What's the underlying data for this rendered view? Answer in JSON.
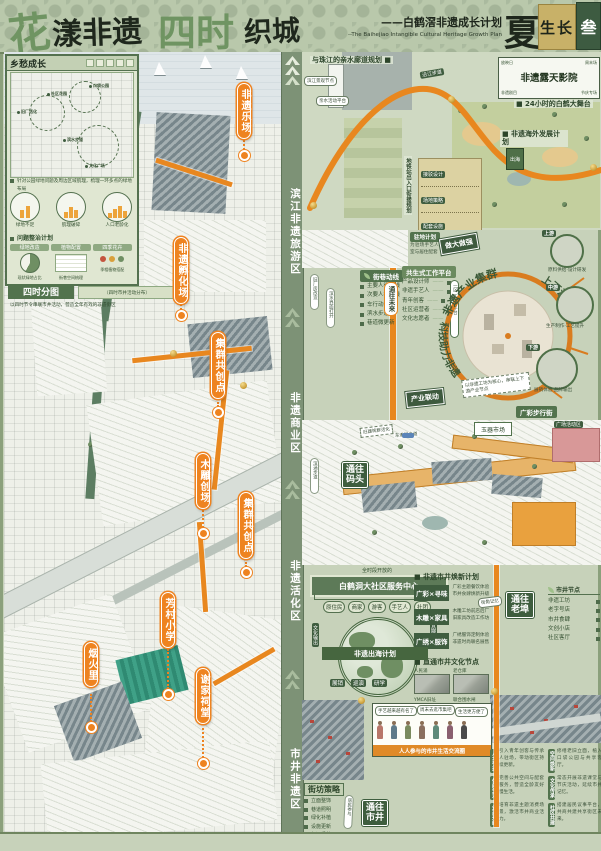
{
  "header": {
    "t1": "花",
    "t2": "漾非遗",
    "t3": "四时",
    "t4": "织城",
    "subtitle_cn": "——白鹤滘非遗成长计划",
    "subtitle_en": "--The Baihejiao Intangible Cultural Heritage Growth Plan",
    "season": "夏",
    "season_word": "生长",
    "board_no": "叁"
  },
  "zones": [
    "滨江非遗旅游区",
    "非遗商业区",
    "非遗活化区",
    "市井非遗区"
  ],
  "left": {
    "inset": {
      "header": "乡愁成长",
      "pins": [
        "旧厂活化",
        "社区花园",
        "口袋公园",
        "滨水步道",
        "文化广场"
      ],
      "note": "针对公园绿地问题及周边区域肌理，梳理一环多点的绿地布局",
      "chart_labels": [
        "绿地不足",
        "肌理破碎",
        "人口老龄化"
      ],
      "sub": "问题整治计划",
      "cols": [
        "绿地改造",
        "植物配置",
        "四季花卉"
      ],
      "col_notes": [
        "现状绿地占比",
        "街巷空间梳理",
        "季相植物搭配"
      ]
    },
    "band2": "四时分图",
    "band2_note": "（四时市井活动分布）",
    "band2_line": "以四时节令串联市井活动，营造全年有戏的非遗街区",
    "callouts": [
      "非遗乐场",
      "非遗孵化场",
      "集群共创点",
      "木雕创场",
      "集群共创点",
      "芳村小学",
      "烟火里",
      "谢家祠堂"
    ]
  },
  "top_right": {
    "header": "与珠江的亲水廊道规划 ■",
    "bubble1": "滨江景观节点",
    "bubble2": "亲水活动平台",
    "road_label": "沿江步道",
    "cinema": {
      "title": "非遗露天影院",
      "tl": "放映日",
      "tr": "周末场",
      "bl": "非遗剧目",
      "br": "节庆专场"
    },
    "stage": "■ 24小时的白鹤大舞台",
    "oversea": "■ 非遗海外发展计划",
    "oversea_tile": "出海",
    "metro": "地铁站出入口衔接规划",
    "panel": [
      "接驳设计",
      "场地策略",
      "配套设施"
    ]
  },
  "mid": {
    "pill1": "旧厂房改造",
    "pill2": "滨水界面打开",
    "future": "通往未来",
    "lane_header": "街巷动线",
    "lanes": [
      "主要人行动线",
      "次要人行动线",
      "车行动线",
      "滨水步道",
      "巷道微更新"
    ],
    "resident": "驻地计划",
    "resident_note": "为驻场手艺人提供工作室与居住配套",
    "platform": "共生式工作平台",
    "platform_items": [
      "产品设计师",
      "非遗手艺人",
      "青年创客",
      "社区运营者",
      "文化志愿者"
    ],
    "platform_tag": "一区一品一平台",
    "arc_top": "非遗产业集群",
    "arc_left": "科技助力非遗",
    "arc_right": "上下游协同",
    "d1": "做大做强",
    "d2": "产业联动",
    "streams": [
      {
        "tag": "上游",
        "note": "原料供给·设计研发"
      },
      {
        "tag": "中游",
        "note": "生产制作·工艺提升"
      },
      {
        "tag": "下游",
        "note": "展销体验·品牌输出"
      }
    ],
    "tilt_note": "以非遗工坊为核心，串联上下游产业节点",
    "street_tag": "广彩步行街"
  },
  "village": {
    "dock": "通往码头",
    "market": "玉器市场",
    "plaza": "广场活动区",
    "road": "东漖涌步道",
    "note": "旧建筑群活化",
    "side": "滨涌步道"
  },
  "community": {
    "note": "全时段开放的",
    "banner": "白鹤洞大社区服务中心",
    "org": [
      "原住民",
      "商家",
      "游客",
      "手艺人",
      "社团"
    ],
    "globe": "非遗出海计划",
    "tag_l": "文化输出",
    "tag_r": "品牌合作",
    "pills": [
      "展销",
      "巡演",
      "研学"
    ]
  },
  "renew": {
    "header": "■ 非遗市井焕新计划",
    "pairs": [
      {
        "tag": "广彩×寻味",
        "l1": "广彩主题餐饮体验",
        "l2": "市井食肆焕新升级"
      },
      {
        "tag": "木雕×家具",
        "l1": "木雕工坊前店后厂",
        "l2": "旧家具改造工作坊"
      },
      {
        "tag": "广绣×服饰",
        "l1": "广绣服饰定制体验",
        "l2": "非遗时尚联名展售"
      }
    ],
    "nodes_header": "■ 直通市井文化节点",
    "photos": [
      "人民涌",
      "老仓库",
      "YMCA旧址",
      "联合围水闸"
    ],
    "legend_header": "市井节点",
    "legend": [
      "非遗工坊",
      "老字号店",
      "市井食肆",
      "文创小店",
      "社区客厅"
    ],
    "oldport": "通往老埠",
    "bubble": "街角记忆"
  },
  "bottom": {
    "strategy": "街坊策略",
    "items": [
      "立面整饰",
      "巷道照明",
      "绿化补植",
      "设施更新",
      "标识系统"
    ],
    "tilt": "居民参与",
    "market": "通往市井",
    "bubbles": [
      "手艺越来越有名了",
      "周末去逛市集吧",
      "生活更方便了"
    ],
    "banner": "人人参与的市井生活交流圈",
    "sections": [
      {
        "h": "人才引进",
        "t": "引入青年创客与传承人驻场，带动街区持续更新。"
      },
      {
        "h": "休闲生活",
        "t": "完善公共空间与配套服务，营造全龄友好慢生活。"
      },
      {
        "h": "业态升级",
        "t": "培育非遗主题消费场景，激活市井商业活力。"
      },
      {
        "h": "空间焕新",
        "t": "修缮老旧立面，植入口袋公园与共享客厅。"
      },
      {
        "h": "文化传承",
        "t": "常态开展非遗课堂与节庆活动，延续市井记忆。"
      },
      {
        "h": "社区共建",
        "t": "搭建居民议事平台，共商共建共享街区未来。"
      }
    ]
  }
}
